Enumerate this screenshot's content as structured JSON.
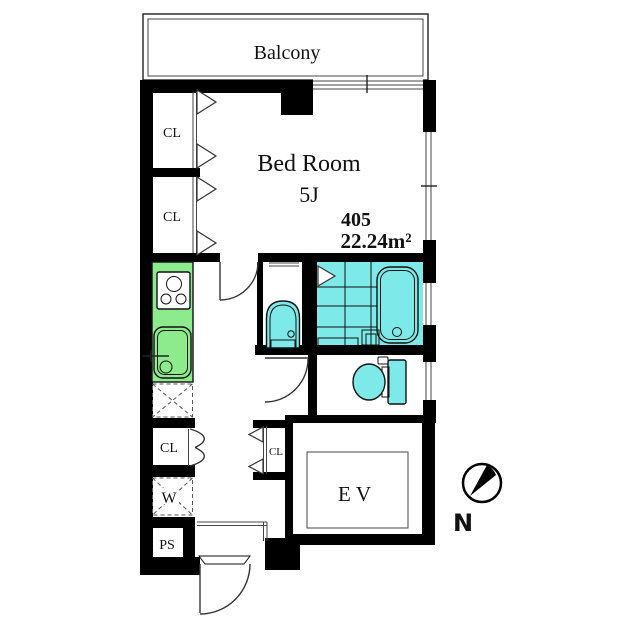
{
  "plan": {
    "labels": {
      "balcony": "Balcony",
      "bedroom": "Bed Room",
      "bedroom_size": "5J",
      "unit_number": "405",
      "unit_area": "22.24m²",
      "closet": "CL",
      "elevator": "EV",
      "washer": "W",
      "pipe_space": "PS",
      "north": "N"
    },
    "colors": {
      "wall": "#000000",
      "outline": "#333333",
      "wet_area": "#7de9e9",
      "kitchen": "#8dea8d",
      "floor": "#ffffff"
    }
  }
}
